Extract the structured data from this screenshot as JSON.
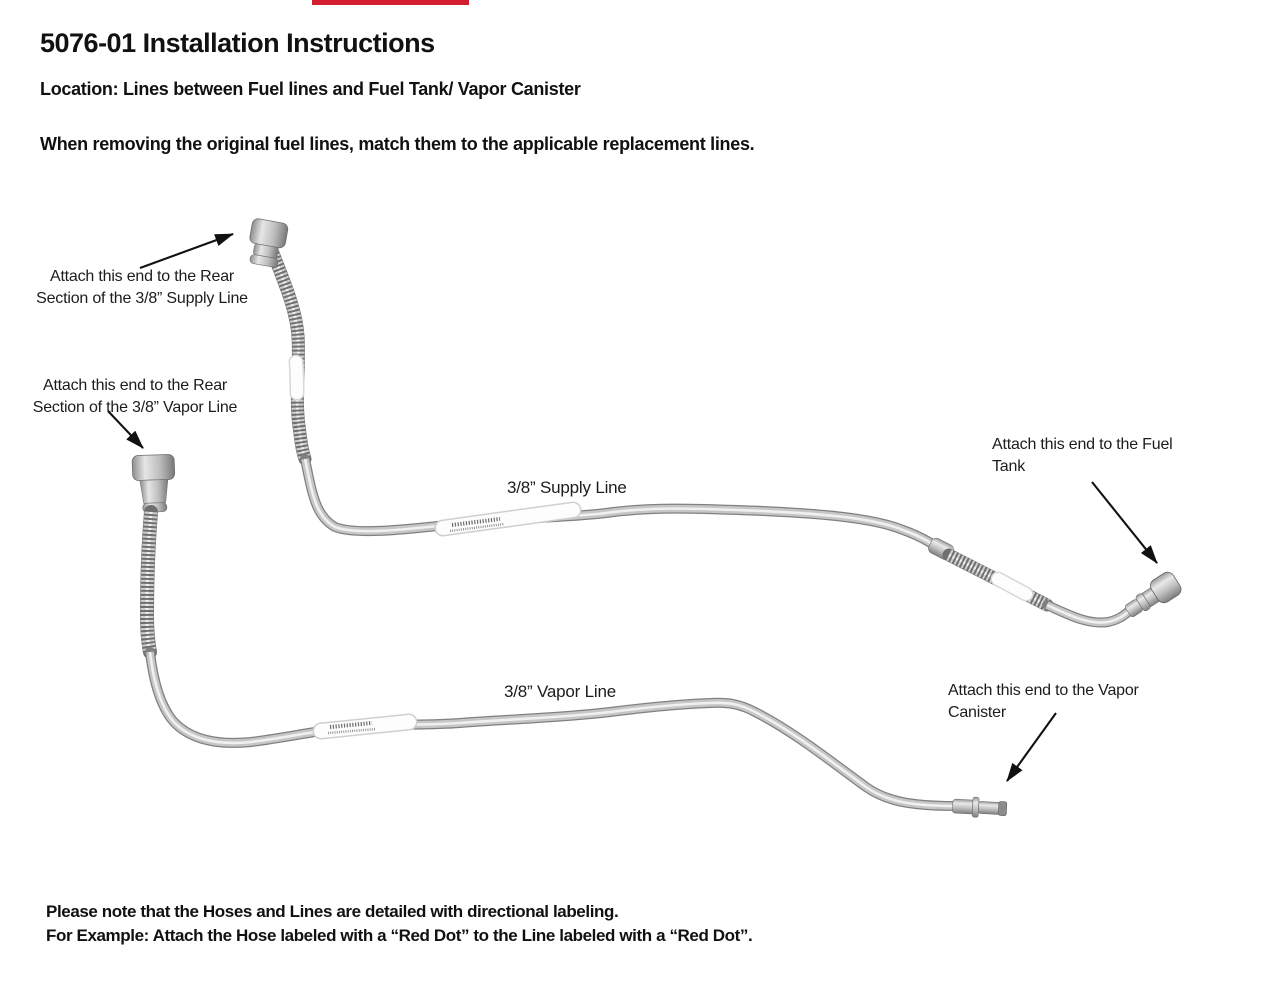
{
  "page": {
    "title": "5076-01 Installation Instructions",
    "location_line": "Location: Lines between Fuel lines and Fuel Tank/ Vapor Canister",
    "intro_line": "When removing the original fuel lines, match them to the applicable replacement lines.",
    "footer_line1": "Please note that the Hoses and Lines are detailed with directional labeling.",
    "footer_line2": "For Example: Attach the Hose labeled with a “Red Dot” to the Line labeled with a “Red Dot”."
  },
  "diagram": {
    "annotations": {
      "supply_rear": {
        "line1": "Attach this end to the Rear",
        "line2": "Section of the 3/8” Supply Line"
      },
      "vapor_rear": {
        "line1": "Attach this end to the Rear",
        "line2": "Section of the 3/8” Vapor Line"
      },
      "supply_label": "3/8” Supply Line",
      "vapor_label": "3/8” Vapor Line",
      "fuel_tank": {
        "line1": "Attach this end to the Fuel",
        "line2": "Tank"
      },
      "vapor_canister": {
        "line1": "Attach this end to the Vapor",
        "line2": "Canister"
      }
    },
    "colors": {
      "top_bar_red": "#d11f2f",
      "arrow_black": "#111111",
      "tube_dark": "#808080",
      "tube_mid": "#c6c6c6",
      "tube_highlight": "#f0f0f0",
      "braid_dark": "#6f6f6f",
      "braid_light": "#cfcfcf",
      "label_sleeve_white": "#fdfdfd",
      "blue_dot": "#5b9bd5"
    }
  }
}
